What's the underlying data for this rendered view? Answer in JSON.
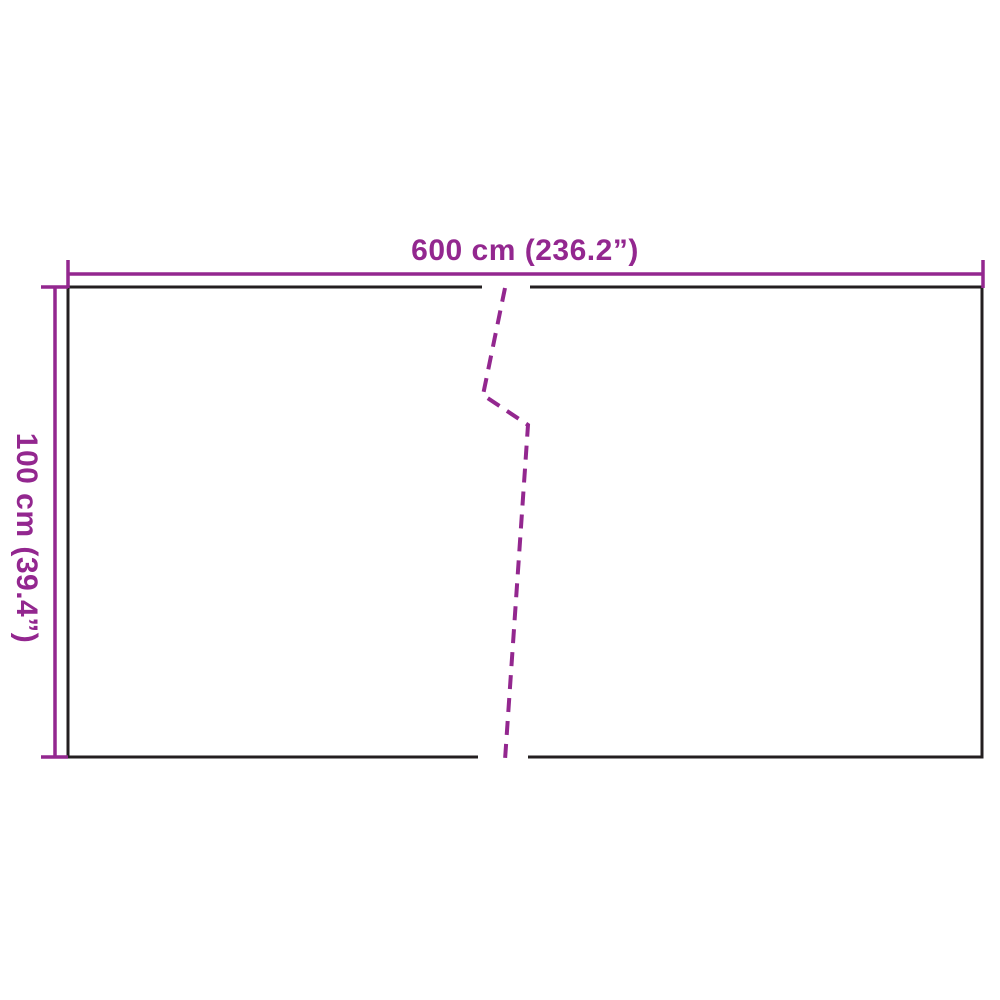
{
  "diagram": {
    "width_label": "600 cm (236.2”)",
    "height_label": "100 cm (39.4”)"
  },
  "colors": {
    "dimension": "#93278F",
    "outline": "#231F20",
    "background": "#FFFFFF"
  }
}
